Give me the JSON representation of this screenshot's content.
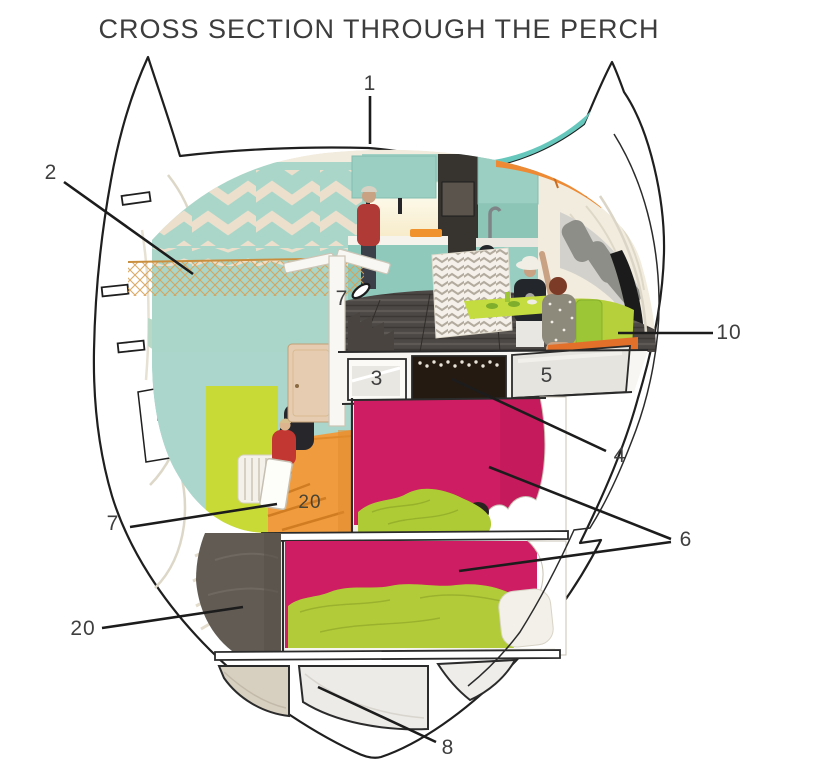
{
  "title": "CROSS SECTION THROUGH THE PERCH",
  "diagram": {
    "type": "architectural cross section",
    "callouts": {
      "c1": "1",
      "c2": "2",
      "c3": "3",
      "c4": "4",
      "c5": "5",
      "c6": "6",
      "c7_upper": "7",
      "c7_lower": "7",
      "c8": "8",
      "c10": "10",
      "c20_stairs": "20",
      "c20_floor": "20"
    },
    "colors": {
      "shell_outline": "#1f1f1f",
      "wall_teal": "#a9d6c9",
      "chevron_cream": "#ecdfcc",
      "ceiling_orange": "#ee8a33",
      "stair_orange": "#f09c3e",
      "bunk_magenta": "#ce1d63",
      "bedding_green": "#b2cc39",
      "wall_lime": "#c8da35",
      "roof_teal": "#66c7bd",
      "floor_dark": "#4c4845",
      "label_text": "#3f3f3f"
    }
  }
}
